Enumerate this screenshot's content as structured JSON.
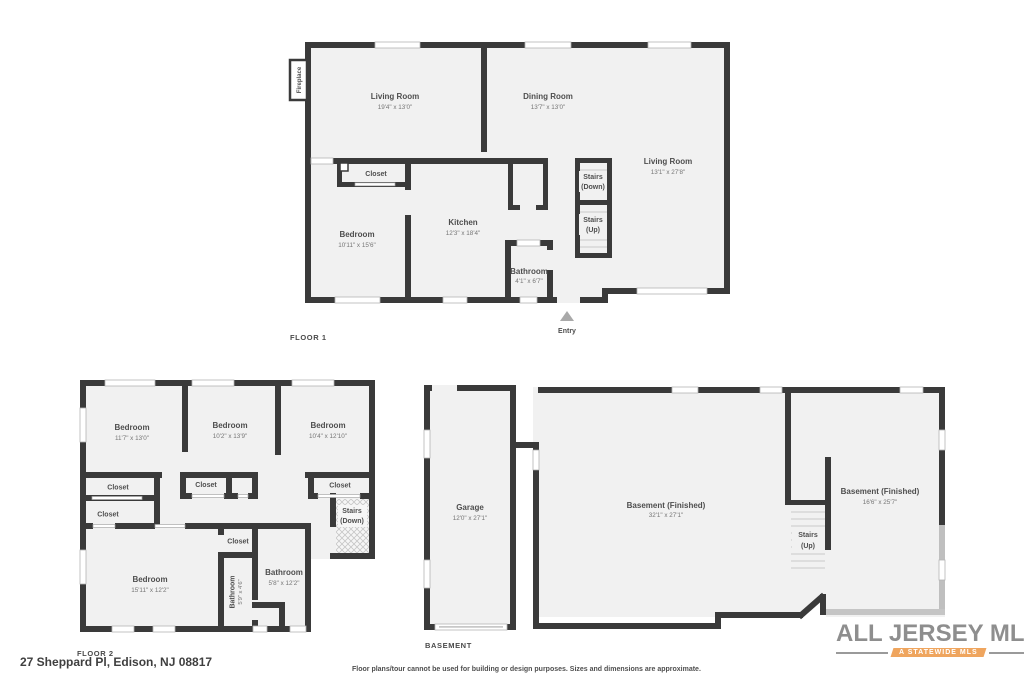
{
  "page": {
    "address": "27 Sheppard Pl, Edison, NJ 08817",
    "disclaimer": "Floor plans/tour cannot be used for building or design purposes. Sizes and dimensions are approximate."
  },
  "logo": {
    "brand": "ALL JERSEY MLS",
    "tagline": "A STATEWIDE MLS",
    "colors": {
      "orange": "#efa55e",
      "teal": "#79a7aa",
      "text_gray": "#8e8e8e"
    }
  },
  "floor1": {
    "title": "FLOOR 1",
    "fireplace": "Fireplace",
    "entry": "Entry",
    "living_left": {
      "name": "Living Room",
      "dims": "19'4\" x 13'0\""
    },
    "dining": {
      "name": "Dining Room",
      "dims": "13'7\" x 13'0\""
    },
    "living_right": {
      "name": "Living Room",
      "dims": "13'1\" x 27'8\""
    },
    "closet": "Closet",
    "bedroom": {
      "name": "Bedroom",
      "dims": "10'11\" x 15'6\""
    },
    "kitchen": {
      "name": "Kitchen",
      "dims": "12'3\" x 18'4\""
    },
    "bathroom": {
      "name": "Bathroom",
      "dims": "4'1\" x 6'7\""
    },
    "stairs_down": {
      "line1": "Stairs",
      "line2": "(Down)"
    },
    "stairs_up": {
      "line1": "Stairs",
      "line2": "(Up)"
    }
  },
  "floor2": {
    "title": "FLOOR 2",
    "bedroom1": {
      "name": "Bedroom",
      "dims": "11'7\" x 13'0\""
    },
    "bedroom2": {
      "name": "Bedroom",
      "dims": "10'2\" x 13'9\""
    },
    "bedroom3": {
      "name": "Bedroom",
      "dims": "10'4\" x 12'10\""
    },
    "bedroom4": {
      "name": "Bedroom",
      "dims": "15'11\" x 12'2\""
    },
    "closet1": "Closet",
    "closet2": "Closet",
    "closet3": "Closet",
    "closet4": "Closet",
    "closet5": "Closet",
    "bathroom_small": {
      "name": "Bathroom",
      "dims": "5'9\" x 4'6\""
    },
    "bathroom": {
      "name": "Bathroom",
      "dims": "5'8\" x 12'2\""
    },
    "stairs_down": {
      "line1": "Stairs",
      "line2": "(Down)"
    }
  },
  "basement": {
    "title": "BASEMENT",
    "garage": {
      "name": "Garage",
      "dims": "12'0\" x 27'1\""
    },
    "basement_main": {
      "name": "Basement (Finished)",
      "dims": "32'1\" x 27'1\""
    },
    "basement_right": {
      "name": "Basement (Finished)",
      "dims": "16'6\" x 25'7\""
    },
    "stairs_up": {
      "line1": "Stairs",
      "line2": "(Up)"
    }
  }
}
